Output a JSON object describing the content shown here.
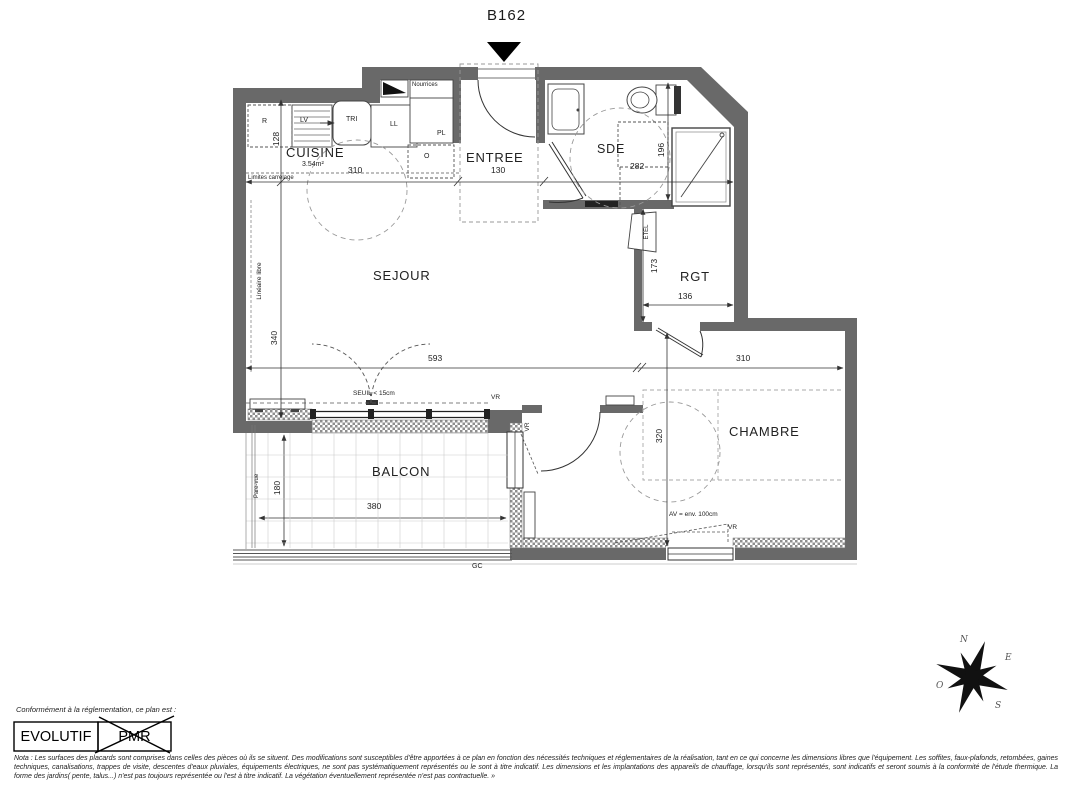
{
  "plan": {
    "unit_number": "B162",
    "rooms": {
      "cuisine": "CUISINE",
      "cuisine_area": "3.54m²",
      "entree": "ENTREE",
      "sde": "SDE",
      "sejour": "SEJOUR",
      "rgt": "RGT",
      "chambre": "CHAMBRE",
      "balcon": "BALCON"
    },
    "dims": {
      "cuisine_width": "310",
      "cuisine_counter_depth": "128",
      "entree_width": "130",
      "sde_width": "282",
      "sde_depth": "196",
      "sejour_depth": "340",
      "sejour_width": "593",
      "rgt_depth": "173",
      "rgt_width": "136",
      "chambre_width": "310",
      "chambre_depth": "320",
      "balcon_width": "380",
      "balcon_depth": "180"
    },
    "labels": {
      "r": "R",
      "lv": "LV",
      "tri": "TRI",
      "ll": "LL",
      "pl": "PL",
      "o": "O",
      "nourrices": "Nourrices",
      "limites_carrelage": "Limites carrelage",
      "lineaire_libre": "Linéaire libre",
      "seuil": "SEUIL < 15cm",
      "vr": "VR",
      "etel": "ETEL",
      "av": "AV = env. 100cm",
      "gc": "GC",
      "pare_vue": "Pare-vue"
    },
    "compass": {
      "n": "N",
      "e": "E",
      "s": "S",
      "o": "O"
    }
  },
  "footer": {
    "conformity": "Conformément à la réglementation, ce plan est :",
    "stamp_evolutif": "EVOLUTIF",
    "stamp_pmr": "PMR",
    "nota": "Nota : Les surfaces des placards sont comprises dans celles des pièces où ils se situent. Des modifications sont susceptibles d'être apportées à ce plan en fonction des nécessités techniques et réglementaires de la réalisation, tant en ce qui concerne les dimensions libres que l'équipement.  Les soffites, faux-plafonds, retombées, gaines techniques, canalisations, trappes de visite, descentes d'eaux pluviales, équipements électriques, ne sont pas systématiquement représentés ou le sont à titre indicatif. Les dimensions et les implantations des appareils de chauffage, lorsqu'ils sont représentés, sont indicatifs et seront soumis à la conformité de l'étude thermique. La forme des jardins( pente, talus...) n'est pas toujours représentée ou l'est à titre indicatif. La végétation éventuellement représentée n'est pas contractuelle. »"
  }
}
